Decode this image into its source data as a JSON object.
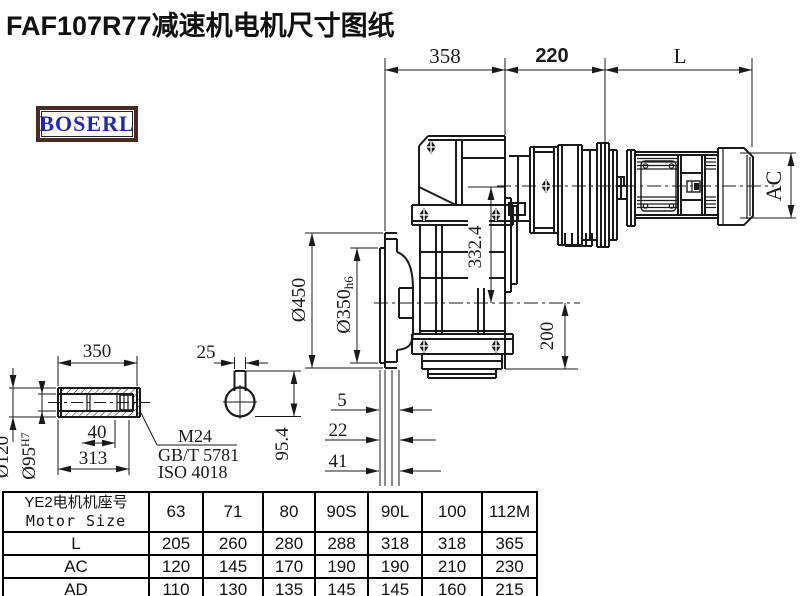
{
  "title": "FAF107R77减速机电机尺寸图纸",
  "logo": "BOSERL",
  "drawing": {
    "top_dims": {
      "d358": "358",
      "d220": "220",
      "dL": "L"
    },
    "main_view": {
      "d332": "332.4",
      "d450": "Ø450",
      "d350": "Ø350",
      "d350_tol": "h6",
      "d200": "200",
      "dAC": "AC",
      "f5": "5",
      "f22": "22",
      "f41": "41"
    },
    "shaft_view": {
      "len350": "350",
      "d25": "25",
      "d120": "Ø120",
      "d95": "Ø95",
      "d95_tol": "H7",
      "d40": "40",
      "len313": "313",
      "d954": "95.4",
      "bolt": "M24",
      "std1": "GB/T 5781",
      "std2": "ISO 4018"
    }
  },
  "table": {
    "header_cn": "YE2电机机座号",
    "header_en": "Motor Size",
    "sizes": [
      "63",
      "71",
      "80",
      "90S",
      "90L",
      "100",
      "112M"
    ],
    "rows": [
      {
        "label": "L",
        "values": [
          "205",
          "260",
          "280",
          "288",
          "318",
          "318",
          "365"
        ]
      },
      {
        "label": "AC",
        "values": [
          "120",
          "145",
          "170",
          "190",
          "190",
          "210",
          "230"
        ]
      },
      {
        "label": "AD",
        "values": [
          "110",
          "130",
          "135",
          "145",
          "145",
          "160",
          "215"
        ]
      }
    ]
  },
  "colors": {
    "line": "#1a1a1a",
    "logo_border": "#4a2a22",
    "logo_text": "#2328b0"
  }
}
